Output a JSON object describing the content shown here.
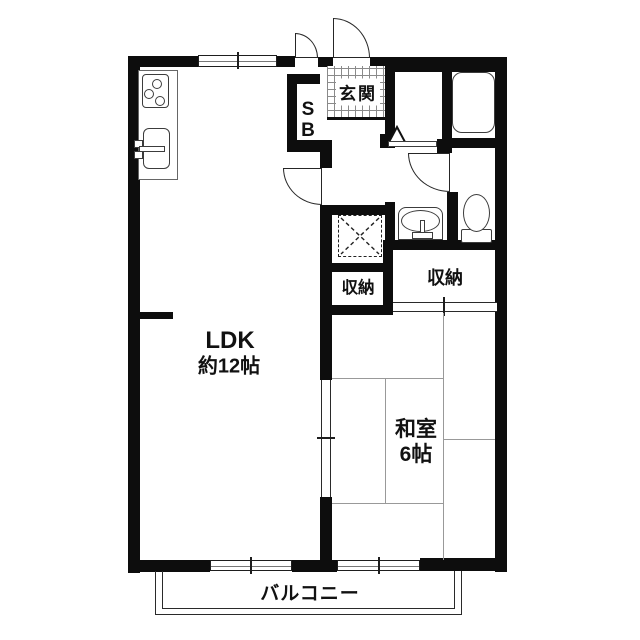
{
  "plan": {
    "type": "apartment-floorplan",
    "entrance": {
      "label": "玄関",
      "shoe_box": [
        "S",
        "B"
      ]
    },
    "storages": {
      "hall": "収納",
      "bedroom": "収納"
    },
    "living": {
      "name": "LDK",
      "size": "約12帖"
    },
    "bedroom": {
      "name": "和室",
      "size": "6帖"
    },
    "balcony": {
      "label": "バルコニー"
    },
    "fixtures": [
      "entrance-door",
      "shoe-box",
      "bathtub",
      "washbasin",
      "toilet",
      "gas-stove",
      "kitchen-sink",
      "washing-machine-pan",
      "entrance-tile-floor"
    ],
    "colors": {
      "wall": "#0d0d0d",
      "fixture_outline": "#3c3c3c",
      "tatami_line": "#999999",
      "background": "#ffffff",
      "text": "#111111"
    }
  }
}
